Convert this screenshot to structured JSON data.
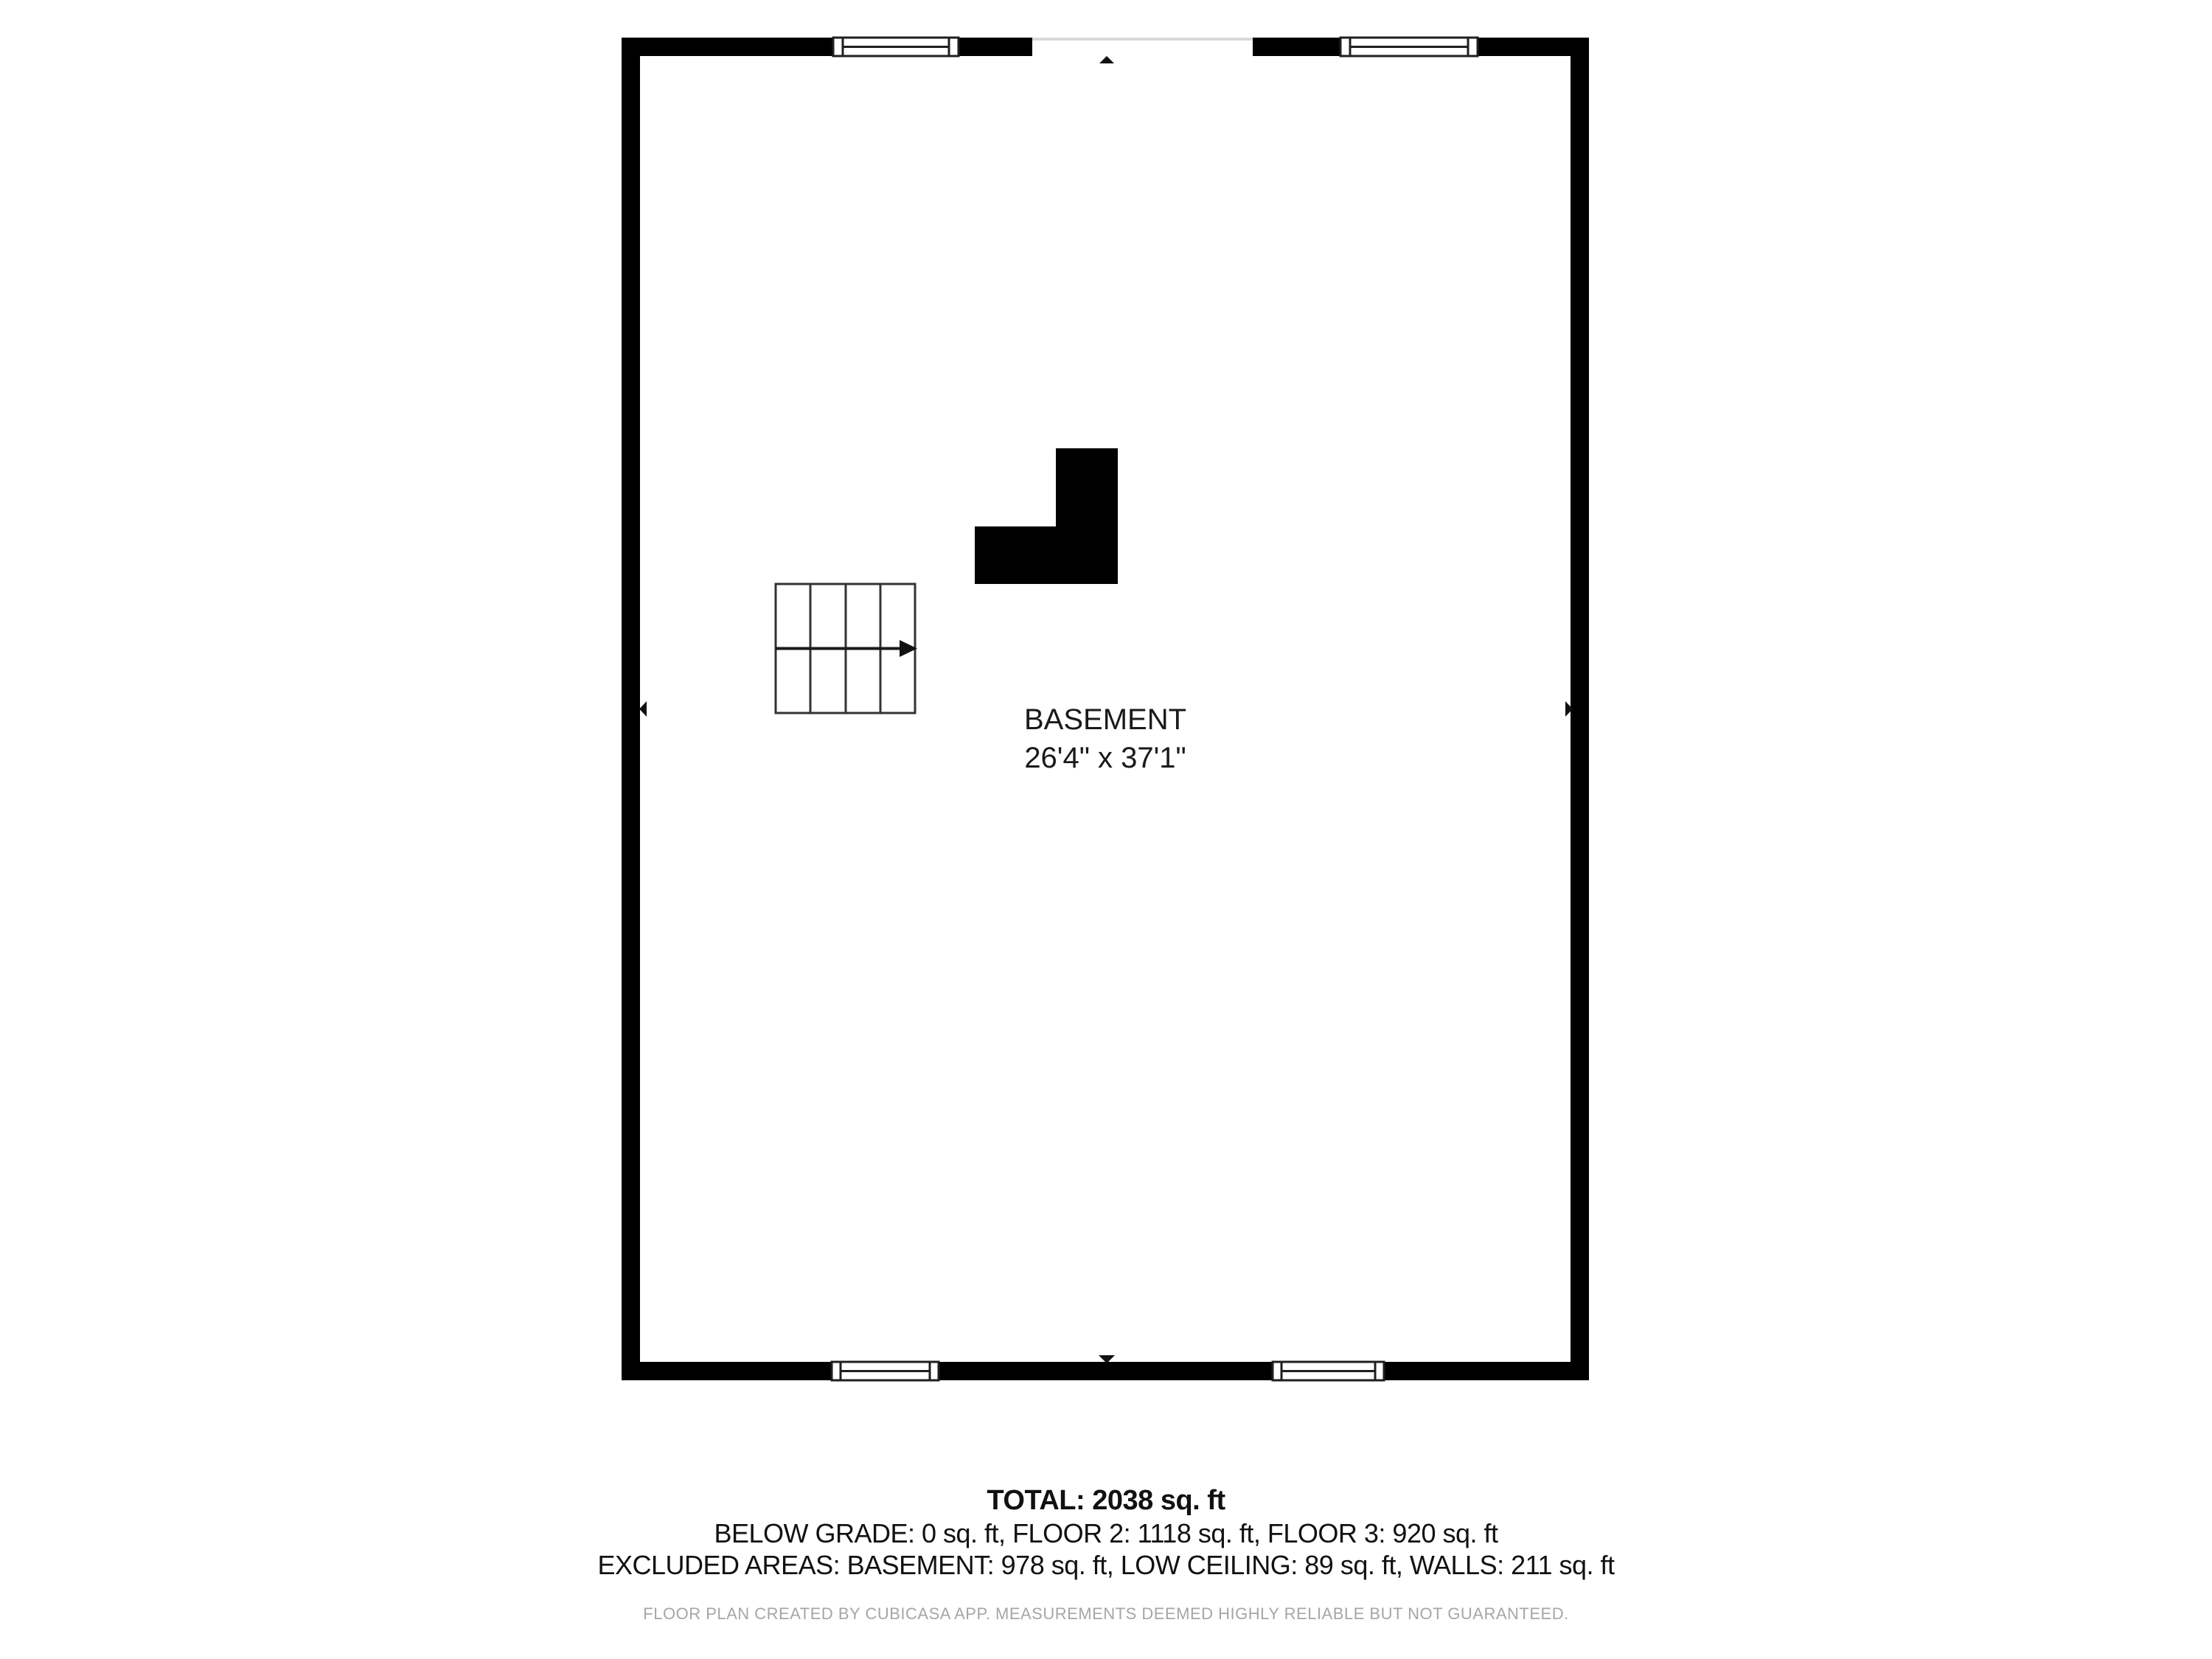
{
  "plan": {
    "room_label": "BASEMENT",
    "room_dimensions": "26'4\" x 37'1\""
  },
  "summary": {
    "total_line": "TOTAL: 2038 sq. ft",
    "floors_line": "BELOW GRADE: 0 sq. ft, FLOOR 2: 1118 sq. ft, FLOOR 3: 920 sq. ft",
    "excluded_line": "EXCLUDED AREAS: BASEMENT: 978 sq. ft, LOW CEILING: 89 sq. ft, WALLS: 211 sq. ft",
    "areas": {
      "total_sqft": 2038,
      "below_grade_sqft": 0,
      "floor2_sqft": 1118,
      "floor3_sqft": 920,
      "excluded_basement_sqft": 978,
      "excluded_low_ceiling_sqft": 89,
      "excluded_walls_sqft": 211
    }
  },
  "footer": {
    "disclaimer": "FLOOR PLAN CREATED BY CUBICASA APP. MEASUREMENTS DEEMED HIGHLY RELIABLE BUT NOT GUARANTEED."
  },
  "colors": {
    "background": "#ffffff",
    "wall": "#000000",
    "window_stroke": "#1f1f1f",
    "stair_stroke": "#333333",
    "opening_line": "#d9d9d9",
    "text": "#1a1a1a",
    "footer_text": "#a6a6a6"
  }
}
